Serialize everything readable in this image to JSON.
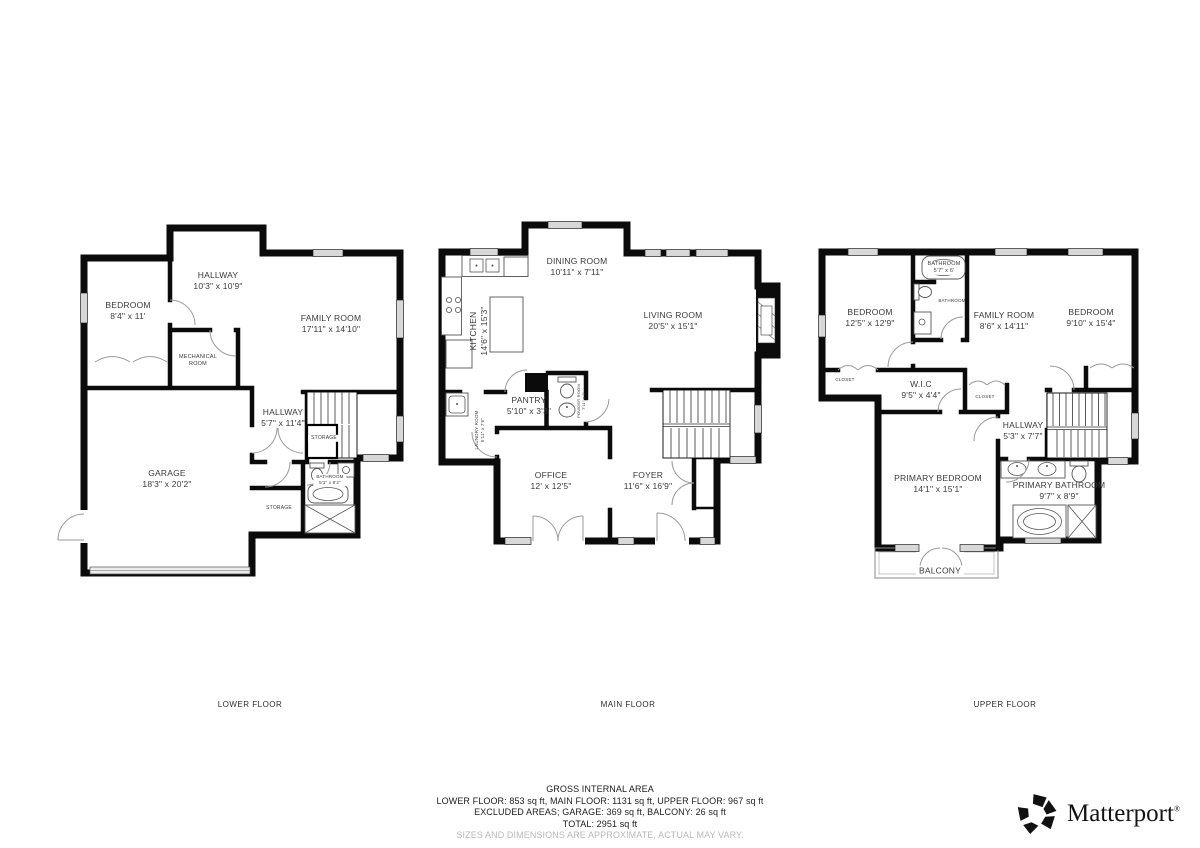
{
  "floors": [
    {
      "title": "LOWER FLOOR",
      "rooms": [
        {
          "name": "HALLWAY",
          "dims": "10'3\" x 10'9\""
        },
        {
          "name": "BEDROOM",
          "dims": "8'4\" x 11'"
        },
        {
          "name": "FAMILY ROOM",
          "dims": "17'11\" x 14'10\""
        },
        {
          "name": "MECHANICAL ROOM",
          "dims": ""
        },
        {
          "name": "HALLWAY",
          "dims": "5'7\" x 11'4\""
        },
        {
          "name": "STORAGE",
          "dims": ""
        },
        {
          "name": "BATHROOM",
          "dims": "5'1\" x 8'2\""
        },
        {
          "name": "STORAGE",
          "dims": ""
        },
        {
          "name": "GARAGE",
          "dims": "18'3\" x 20'2\""
        }
      ]
    },
    {
      "title": "MAIN FLOOR",
      "rooms": [
        {
          "name": "DINING ROOM",
          "dims": "10'11\" x 7'11\""
        },
        {
          "name": "KITCHEN",
          "dims": "14'6\" x 15'3\""
        },
        {
          "name": "LIVING ROOM",
          "dims": "20'5\" x 15'1\""
        },
        {
          "name": "PANTRY",
          "dims": "5'10\" x 3'3\""
        },
        {
          "name": "POWDER ROOM",
          "dims": "7'11\" x 3'"
        },
        {
          "name": "LAUNDRY ROOM",
          "dims": "5'11\" x 7'6\""
        },
        {
          "name": "OFFICE",
          "dims": "12' x 12'5\""
        },
        {
          "name": "FOYER",
          "dims": "11'6\" x 16'9\""
        }
      ]
    },
    {
      "title": "UPPER FLOOR",
      "rooms": [
        {
          "name": "BATHROOM",
          "dims": "5'7\" x 6'"
        },
        {
          "name": "BEDROOM",
          "dims": "12'5\" x 12'9\""
        },
        {
          "name": "BATHROOM",
          "dims": ""
        },
        {
          "name": "FAMILY ROOM",
          "dims": "8'6\" x 14'11\""
        },
        {
          "name": "BEDROOM",
          "dims": "9'10\" x 15'4\""
        },
        {
          "name": "CLOSET",
          "dims": ""
        },
        {
          "name": "W.I.C",
          "dims": "9'5\" x 4'4\""
        },
        {
          "name": "CLOSET",
          "dims": ""
        },
        {
          "name": "HALLWAY",
          "dims": "5'3\" x 7'7\""
        },
        {
          "name": "PRIMARY BEDROOM",
          "dims": "14'1\" x 15'1\""
        },
        {
          "name": "PRIMARY BATHROOM",
          "dims": "9'7\" x 8'9\""
        },
        {
          "name": "BALCONY",
          "dims": ""
        }
      ]
    }
  ],
  "footer": {
    "gross": "GROSS INTERNAL AREA",
    "line1": "LOWER FLOOR: 853 sq ft, MAIN FLOOR: 1131 sq ft, UPPER FLOOR: 967 sq ft",
    "line2": "EXCLUDED AREAS; GARAGE: 369 sq ft, BALCONY: 26 sq ft",
    "total": "TOTAL: 2951 sq ft",
    "disclaimer": "SIZES AND DIMENSIONS ARE APPROXIMATE, ACTUAL MAY VARY."
  },
  "brand": {
    "name": "Matterport",
    "mark": "®"
  },
  "colors": {
    "wall": "#0b0b0b",
    "label": "#3a3a3a",
    "window": "#d8d8d8",
    "disclaimer": "#b9b9b9"
  }
}
